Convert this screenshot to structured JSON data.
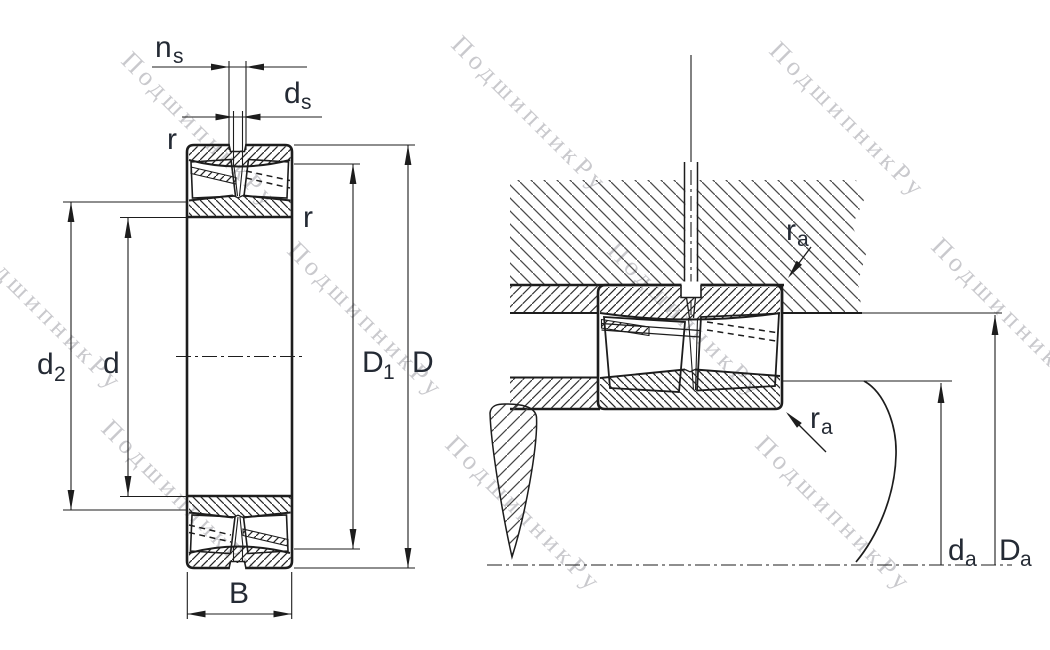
{
  "drawing_type": "bearing dimension drawing",
  "views": {
    "section_view": {
      "labels": {
        "ns": {
          "main": "n",
          "sub": "s"
        },
        "ds": {
          "main": "d",
          "sub": "s"
        },
        "r_outer": "r",
        "r_inner": "r",
        "d2": {
          "main": "d",
          "sub": "2"
        },
        "d": "d",
        "D1": {
          "main": "D",
          "sub": "1"
        },
        "D": "D",
        "B": "B"
      }
    },
    "mounting_view": {
      "labels": {
        "ra_housing": {
          "main": "r",
          "sub": "a"
        },
        "ra_shaft": {
          "main": "r",
          "sub": "a"
        },
        "da": {
          "main": "d",
          "sub": "a"
        },
        "Da": {
          "main": "D",
          "sub": "a"
        }
      }
    }
  },
  "watermark": {
    "text": "ПодшипникРу",
    "color": "#c9c9cd"
  },
  "colors": {
    "line": "#1d1d1d",
    "label": "#242a34",
    "background": "#ffffff",
    "housing_hatch": "#4a4a4a",
    "ring_hatch": "#262626"
  }
}
